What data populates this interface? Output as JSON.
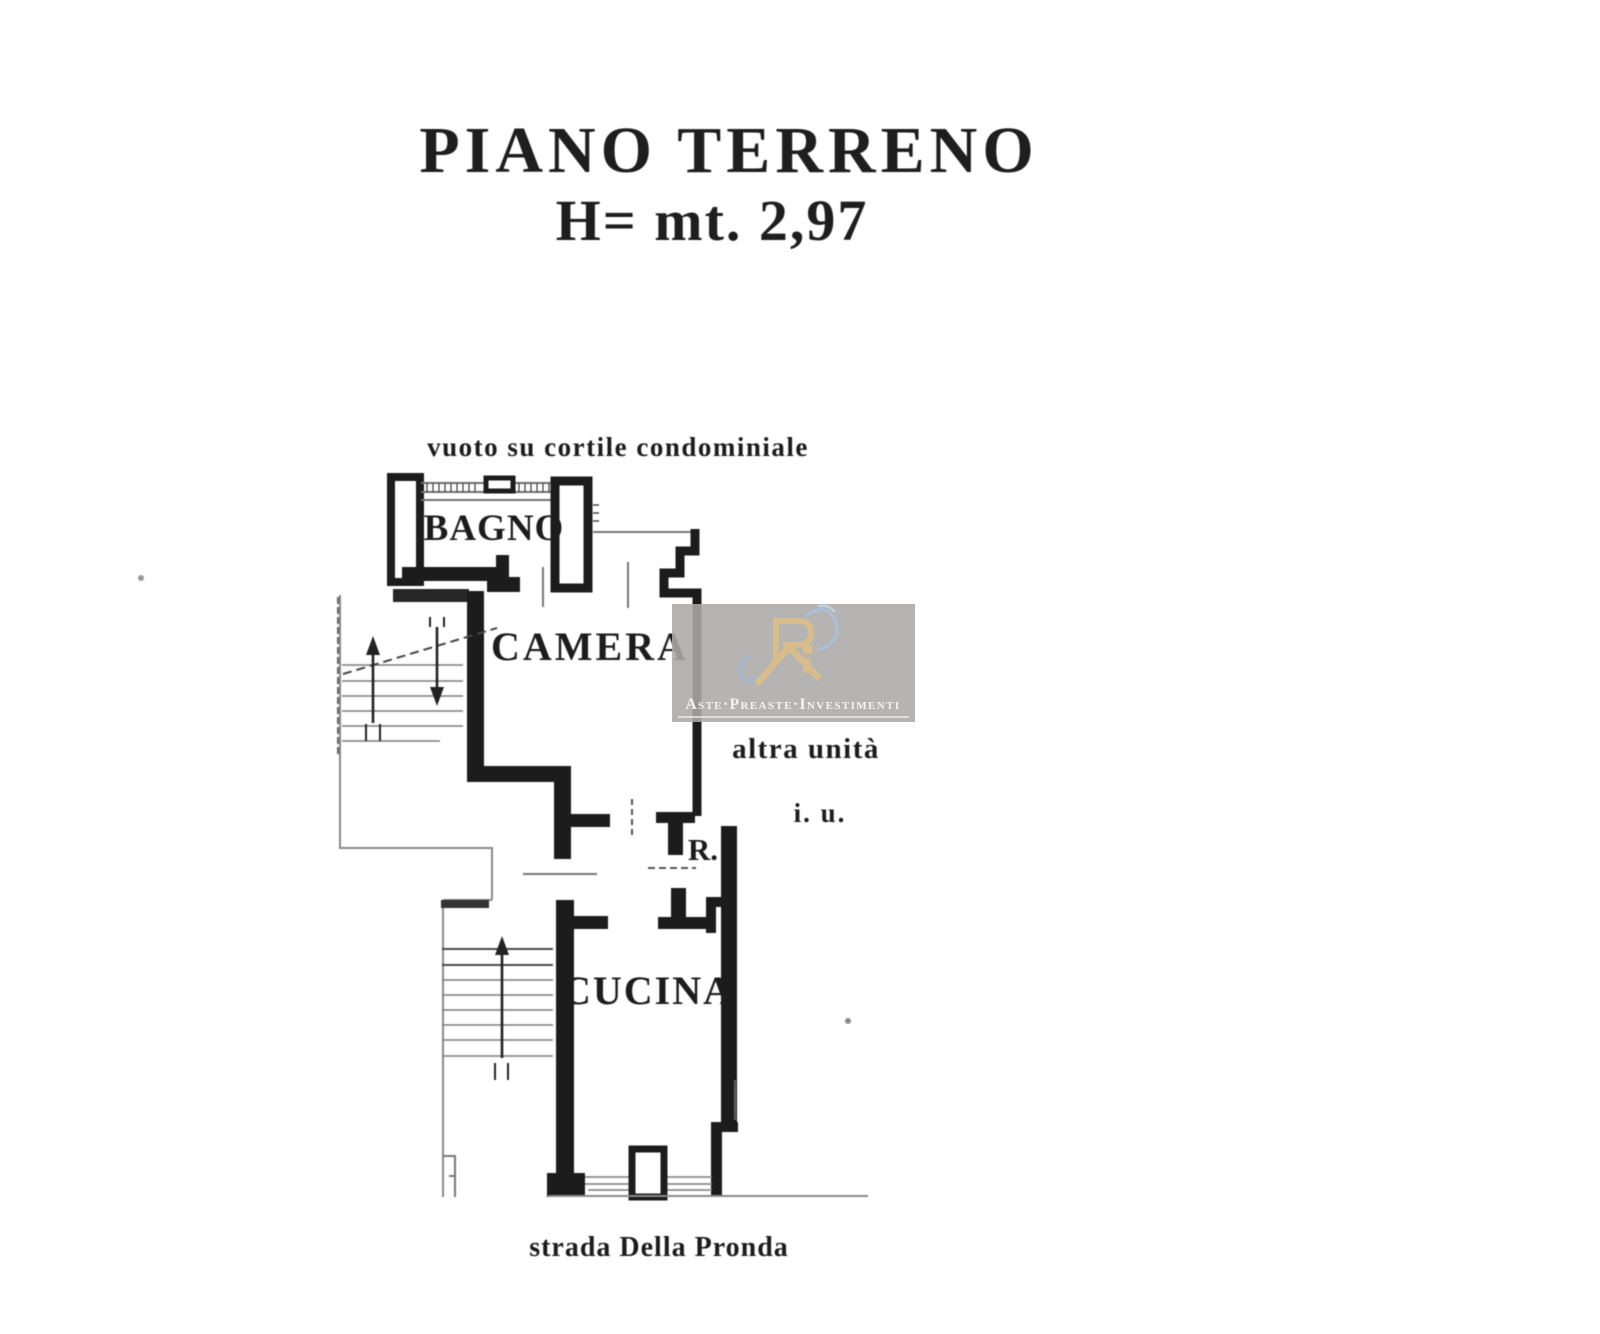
{
  "document": {
    "background_color": "#ffffff",
    "title_line1": "PIANO TERRENO",
    "title_line2": "H= mt. 2,97"
  },
  "plan": {
    "labels": {
      "courtyard": "vuoto su cortile condominiale",
      "bagno": "BAGNO",
      "camera": "CAMERA",
      "altra_unita": "altra unità",
      "i_u": "i. u.",
      "r": "R.",
      "cucina": "CUCINA",
      "street": "strada Della Pronda"
    },
    "colors": {
      "wall": "#1c1c1c",
      "thin_line": "#777777",
      "dash_line": "#555555"
    }
  },
  "watermark": {
    "text": "Aste·Preaste·Investimenti",
    "background_color": "#acaaa8",
    "logo_gold": "#d8bd8a",
    "logo_blue": "#a8c2e0",
    "text_color": "#f4f4f4"
  }
}
